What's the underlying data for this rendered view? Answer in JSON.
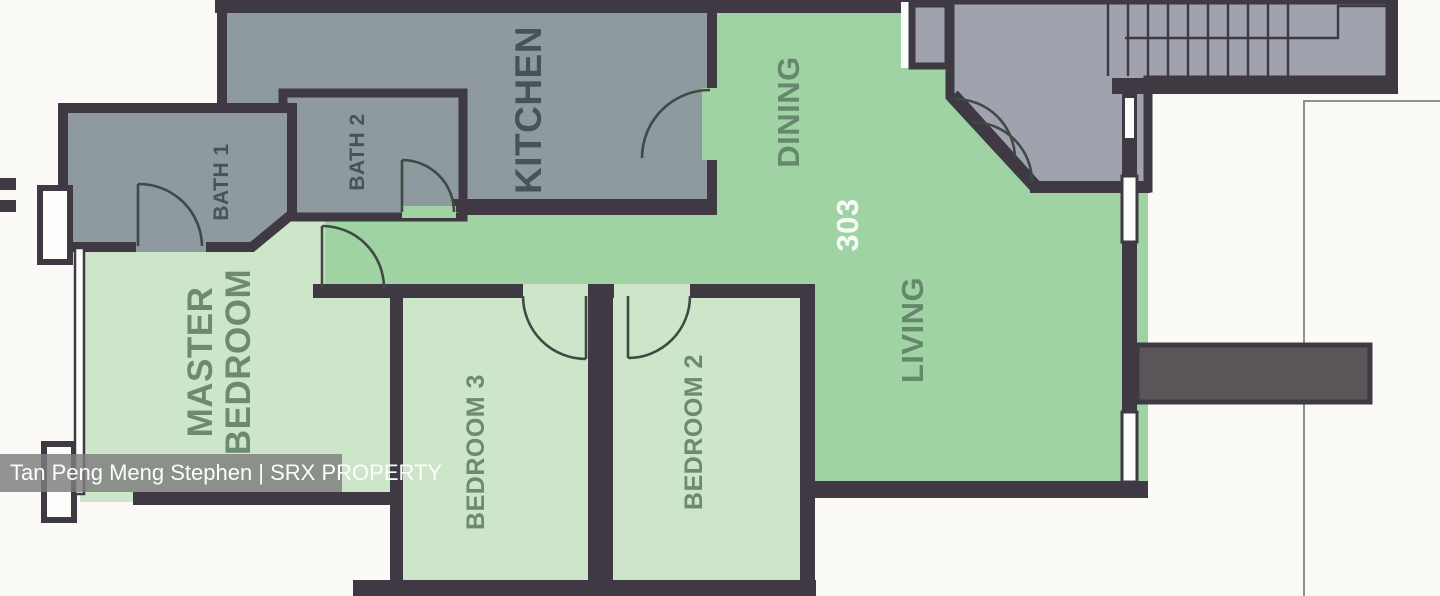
{
  "watermark": {
    "text": "Tan Peng Meng Stephen | SRX PROPERTY"
  },
  "unit_number": "303",
  "rooms": {
    "kitchen": {
      "label": "KITCHEN"
    },
    "dining": {
      "label": "DINING"
    },
    "living": {
      "label": "LIVING"
    },
    "bath1": {
      "label": "BATH 1"
    },
    "bath2": {
      "label": "BATH 2"
    },
    "master_bedroom": {
      "label_line1": "MASTER",
      "label_line2": "BEDROOM"
    },
    "bedroom3": {
      "label": "BEDROOM 3"
    },
    "bedroom2": {
      "label": "BEDROOM 2"
    }
  },
  "colors": {
    "paper": "#fbfaf7",
    "wall": "#3e3943",
    "gray_room": "#8e99a0",
    "foyer": "#a0a2ad",
    "green": "#9fd3a3",
    "pale_green": "#cde5c8",
    "ledge": "#5b5458",
    "watermark_bg": "rgba(125,125,125,0.82)"
  }
}
